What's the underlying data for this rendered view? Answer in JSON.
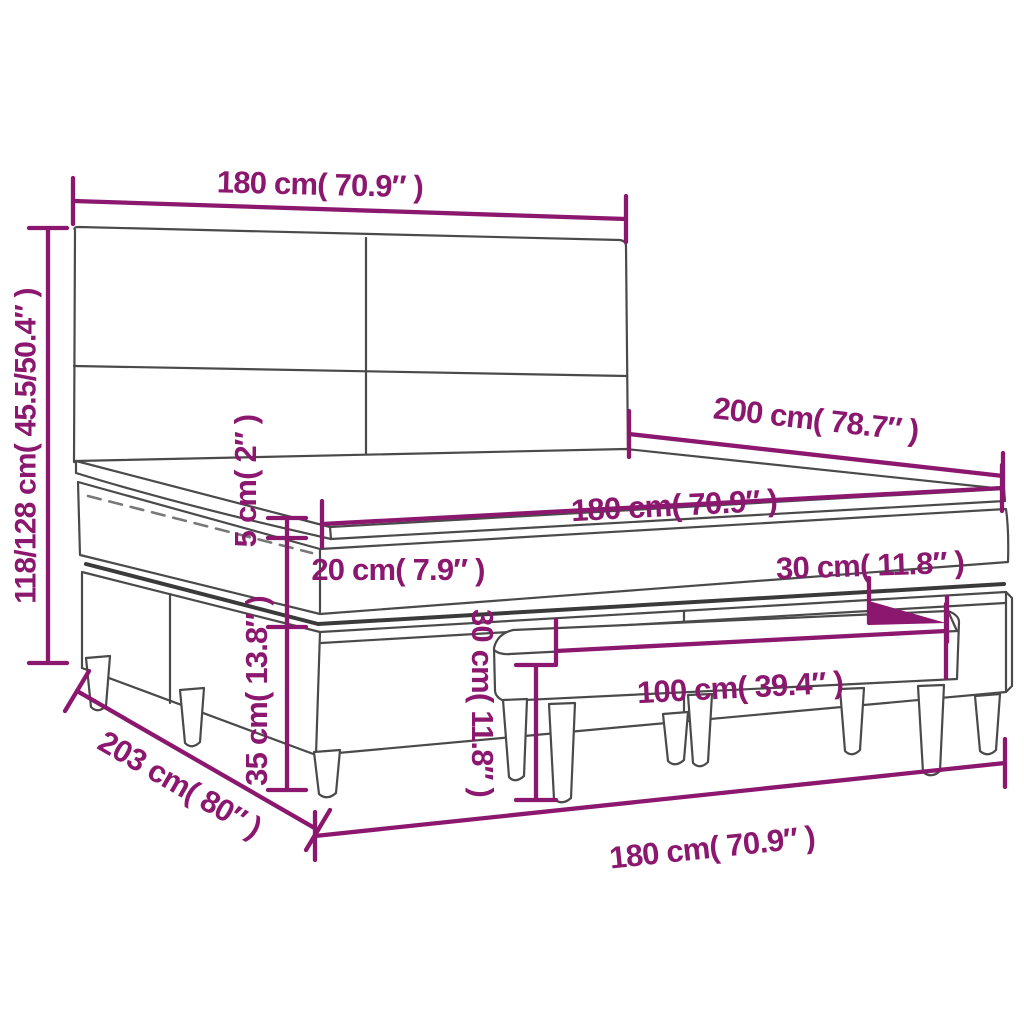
{
  "colors": {
    "dimension": "#8B186E",
    "outline": "#4a4a4a",
    "shadow": "#3a3a3a",
    "zipper": "#787878"
  },
  "dimensions": {
    "headboard_width": {
      "label": "180 cm( 70.9″ )"
    },
    "bed_height": {
      "label": "118/128 cm( 45.5/50.4″ )"
    },
    "bed_length": {
      "label": "200 cm( 78.7″ )"
    },
    "mattress_width": {
      "label": "180 cm( 70.9″ )"
    },
    "topper_thickness": {
      "label": "5 cm( 2″ )"
    },
    "mattress_thickness": {
      "label": "20 cm( 7.9″ )"
    },
    "base_height": {
      "label": "35 cm( 13.8″ )"
    },
    "bench_depth": {
      "label": "30 cm( 11.8″ )"
    },
    "bench_height": {
      "label": "30 cm( 11.8″ )"
    },
    "bench_length": {
      "label": "100 cm( 39.4″ )"
    },
    "base_length": {
      "label": "203 cm( 80″ )"
    },
    "bed_width": {
      "label": "180 cm( 70.9″ )"
    }
  }
}
